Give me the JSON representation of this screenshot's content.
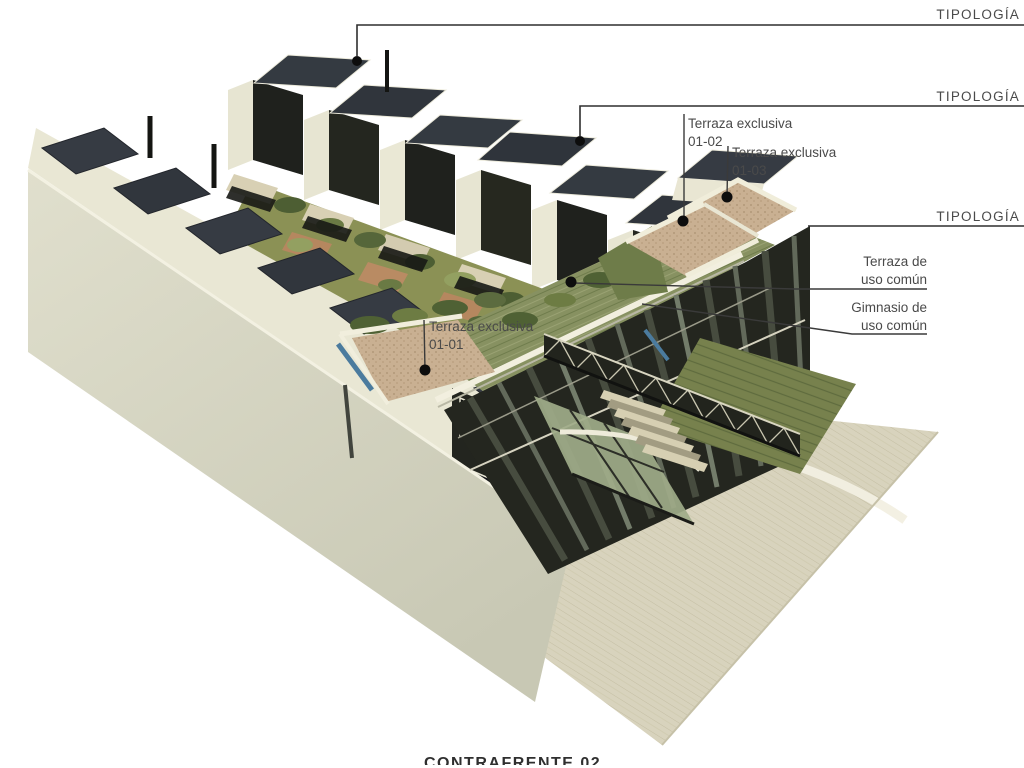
{
  "annotations": {
    "tipologia_1": {
      "label": "TIPOLOGÍA"
    },
    "tipologia_2": {
      "label": "TIPOLOGÍA"
    },
    "tipologia_3": {
      "label": "TIPOLOGÍA"
    },
    "terraza_01_02": {
      "line1": "Terraza exclusiva",
      "line2": "01-02"
    },
    "terraza_01_03": {
      "line1": "Terraza exclusiva",
      "line2": "01-03"
    },
    "terraza_01_01": {
      "line1": "Terraza exclusiva",
      "line2": "01-01"
    },
    "terraza_comun": {
      "line1": "Terraza de",
      "line2": "uso común"
    },
    "gimnasio": {
      "line1": "Gimnasio de",
      "line2": "uso común"
    },
    "caption": {
      "text": "CONTRAFRENTE 02"
    }
  },
  "colors": {
    "background": "#ffffff",
    "annotation_text": "#4a4a4a",
    "leader_line": "#3a3a3a",
    "marker_dot": "#0d0d0d",
    "cream_wall": "#dcdbc8",
    "cream_light": "#f1eedd",
    "dark_facade": "#22241e",
    "slate_roof": "#363b43",
    "green_roof": "#879161",
    "vegetation_dark": "#4d5e33",
    "gravel_terrace": "#c9b092",
    "plaza_ground": "#d8d3bd",
    "glass_green": "#9fab89",
    "pool_blue": "#4b7b9e",
    "brick_patio": "#b5875f"
  }
}
